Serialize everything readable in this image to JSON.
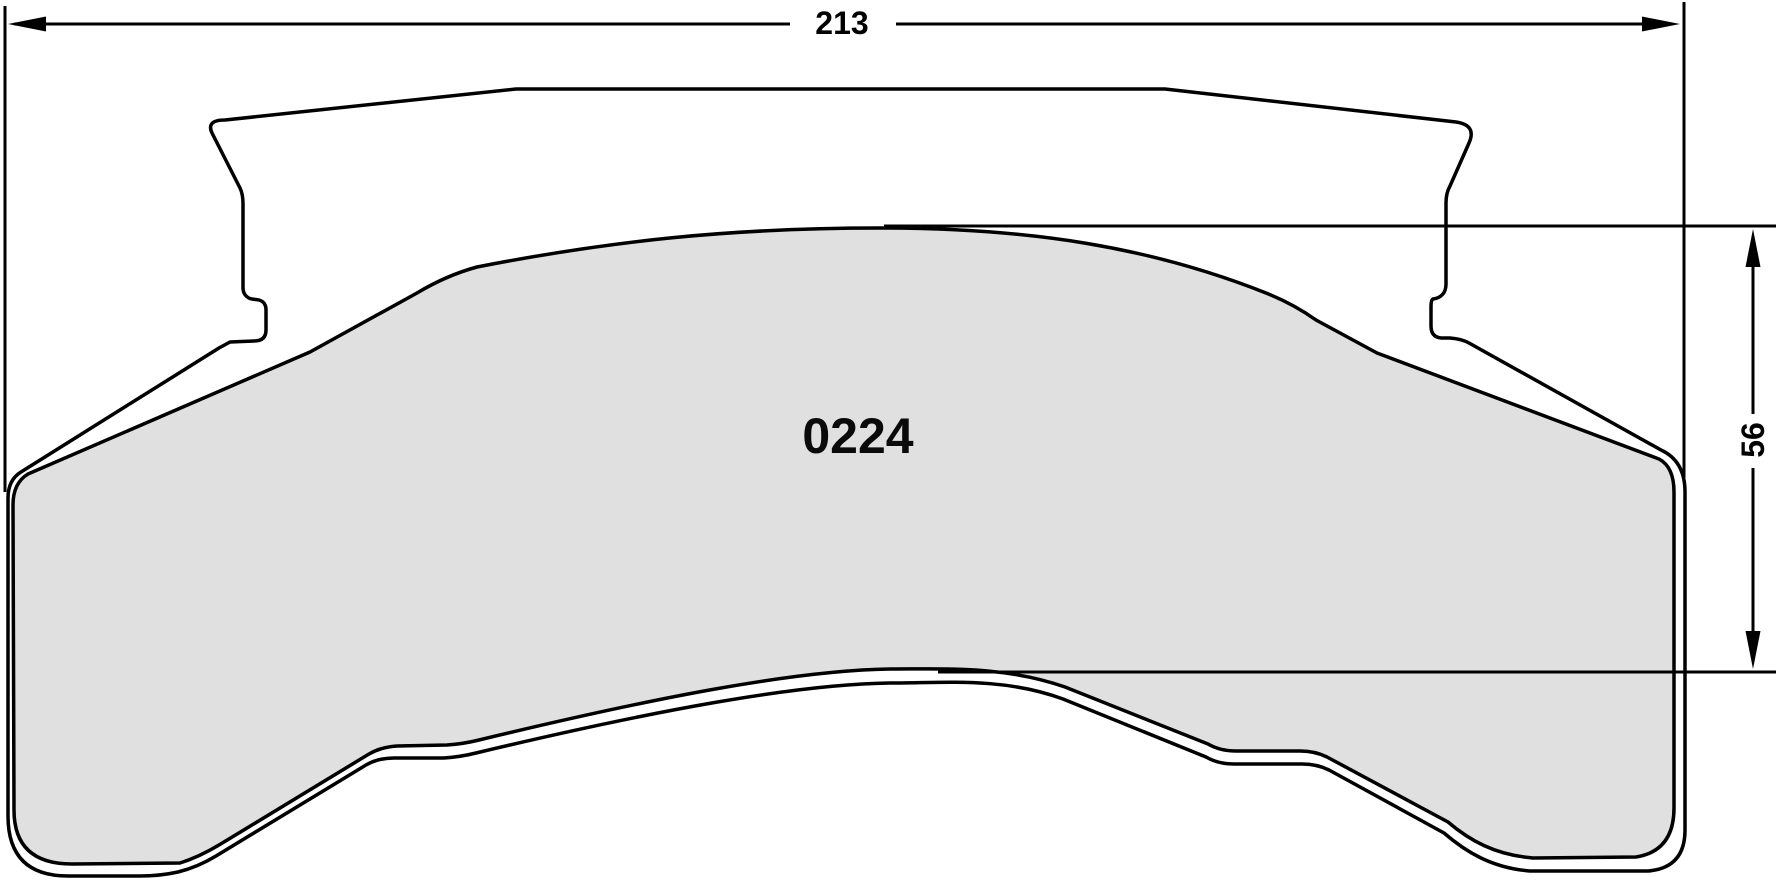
{
  "drawing": {
    "type": "brake-pad-technical-drawing",
    "part_number": "0224",
    "dimensions": {
      "width": {
        "label": "213"
      },
      "height": {
        "label": "56"
      }
    },
    "colors": {
      "line": "#000000",
      "friction_fill": "#e0e0e0",
      "background": "#ffffff"
    }
  }
}
